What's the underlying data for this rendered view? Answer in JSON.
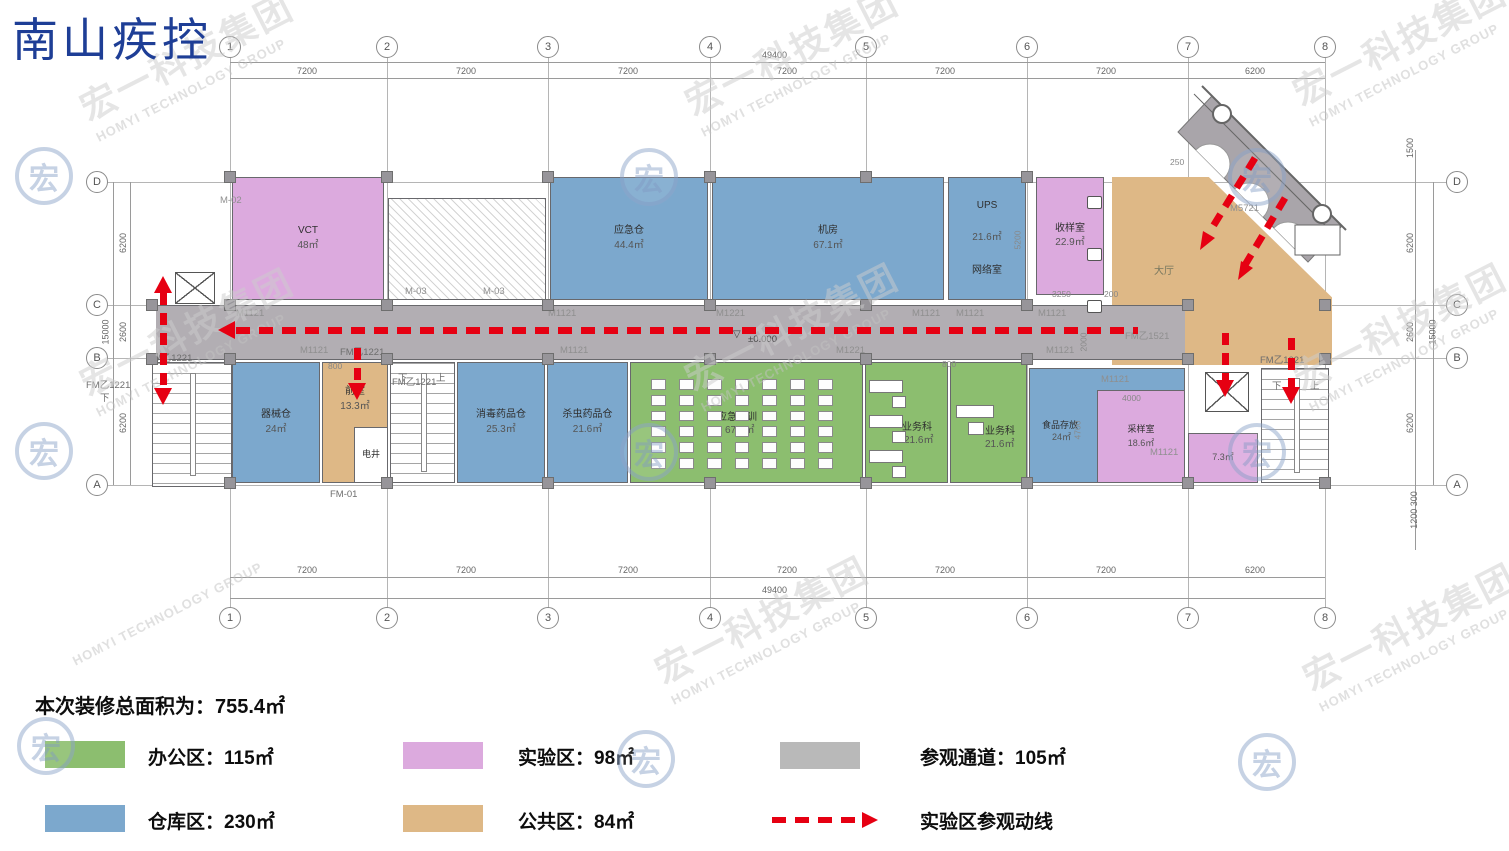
{
  "title": "南山疾控",
  "brand": {
    "name": "宏一科技集团",
    "name_en": "HOMYI TECHNOLOGY GROUP"
  },
  "grid": {
    "cols": [
      "1",
      "2",
      "3",
      "4",
      "5",
      "6",
      "7",
      "8"
    ],
    "rows": [
      "D",
      "C",
      "B",
      "A"
    ],
    "top_dims": [
      "7200",
      "7200",
      "7200",
      "7200",
      "7200",
      "7200",
      "6200"
    ],
    "bottom_dims": [
      "7200",
      "7200",
      "7200",
      "7200",
      "7200",
      "7200",
      "6200"
    ],
    "total": "49400",
    "left_dims": [
      "6200",
      "2600",
      "6200"
    ],
    "left_total": "15000",
    "right_top": "1500",
    "right_dims": [
      "6200",
      "2600",
      "6200"
    ],
    "right_total": "15000",
    "right_bottom": "1200 300"
  },
  "rooms": {
    "vct": {
      "name": "VCT",
      "area": "48㎡"
    },
    "yingjicang": {
      "name": "应急仓",
      "area": "44.4㎡"
    },
    "jifang": {
      "name": "机房",
      "area": "67.1㎡"
    },
    "ups": {
      "name": "UPS",
      "area": "21.6㎡",
      "name2": "网络室"
    },
    "shouyangshi": {
      "name": "收样室",
      "area": "22.9㎡"
    },
    "dating": {
      "name": "大厅"
    },
    "qixiecang": {
      "name": "器械仓",
      "area": "24㎡"
    },
    "qianshi": {
      "name": "前室",
      "area": "13.3㎡"
    },
    "dianjing": {
      "name": "电井"
    },
    "xiaodu": {
      "name": "消毒药品仓",
      "area": "25.3㎡"
    },
    "shachong": {
      "name": "杀虫药品仓",
      "area": "21.6㎡"
    },
    "peixun": {
      "name": "应急培训",
      "area": "67.1㎡"
    },
    "yewuke1": {
      "name": "业务科",
      "area": "21.6㎡"
    },
    "yewuke2": {
      "name": "业务科",
      "area": "21.6㎡"
    },
    "shipin": {
      "name": "食品存放",
      "area": "24㎡"
    },
    "caiyang": {
      "name": "采样室",
      "area": "18.6㎡"
    },
    "xiaopink": {
      "area": "7.3㎡"
    }
  },
  "doors": {
    "m02": "M-02",
    "m03": "M-03",
    "m1121": "M1121",
    "m1221": "M1221",
    "fm1221": "FM乙1221",
    "fm1521": "FM乙1521",
    "fm1021": "FM乙1021",
    "fm01": "FM-01",
    "m5721": "M5721"
  },
  "stairs": {
    "down": "下",
    "up": "上"
  },
  "level": "±0.000",
  "dims": {
    "d800": "800",
    "d4000": "4000",
    "d4700": "4700",
    "d3250": "3250",
    "d200": "200",
    "d250": "250",
    "d5200": "5200",
    "d2000": "2000"
  },
  "legend": {
    "total": "本次装修总面积为：755.4㎡",
    "office": "办公区：115㎡",
    "lab": "实验区：98㎡",
    "corridor": "参观通道：105㎡",
    "warehouse": "仓库区：230㎡",
    "public": "公共区：84㎡",
    "route": "实验区参观动线"
  },
  "colors": {
    "office": "#8cbe6f",
    "warehouse": "#7ca8cd",
    "lab": "#dcaade",
    "public": "#deb886",
    "corridor": "#b2aeb3",
    "route": "#e60012"
  }
}
